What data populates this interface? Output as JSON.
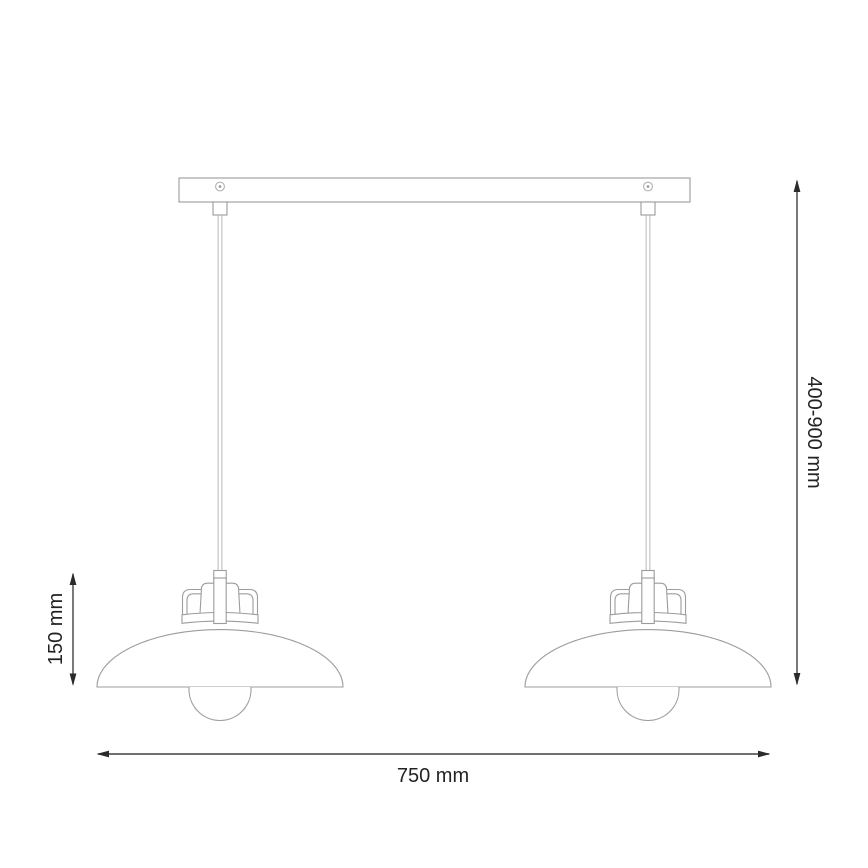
{
  "diagram": {
    "name": "double-pendant-lamp-dimension-drawing",
    "labels": {
      "drop_height": "400-900 mm",
      "shade_height": "150 mm",
      "overall_width": "750 mm"
    },
    "colors": {
      "product_outline": "#9a9c9f",
      "dimension_line": "#3f4042",
      "label_text": "#232323",
      "background": "#ffffff"
    }
  }
}
